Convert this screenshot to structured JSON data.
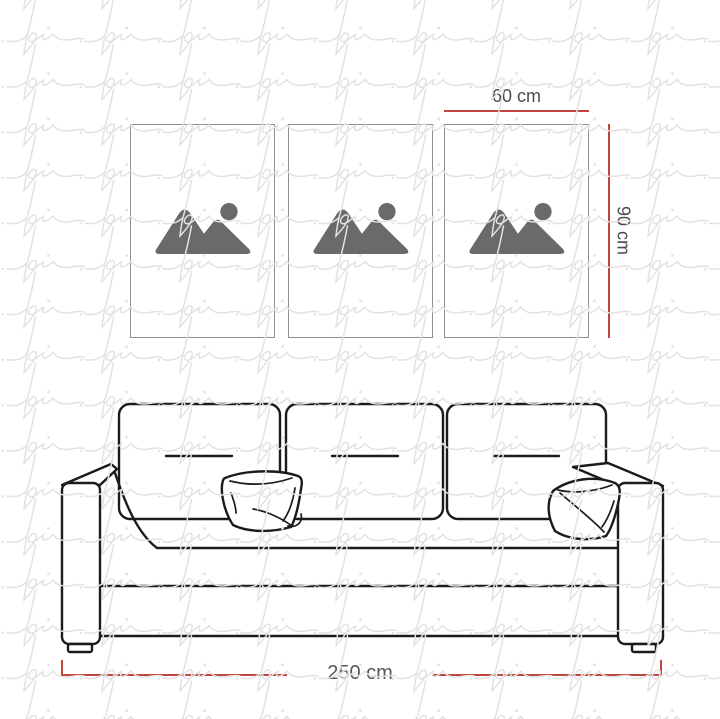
{
  "watermark": {
    "text": "pi"
  },
  "frames": {
    "count": 3,
    "placeholder_icon": "image-placeholder-icon"
  },
  "dimensions": {
    "frame_width": {
      "label": "60 cm"
    },
    "frame_height": {
      "label": "90 cm"
    },
    "sofa_width": {
      "label": "250 cm"
    }
  },
  "colors": {
    "background": "#ffffff",
    "dimension_line": "#c0453e",
    "dimension_text": "#4c4c4c",
    "frame_border": "#8f8f8f",
    "placeholder_icon": "#6a6a6a",
    "sofa_line": "#1b1b1b",
    "watermark": "#e2e2e2"
  }
}
